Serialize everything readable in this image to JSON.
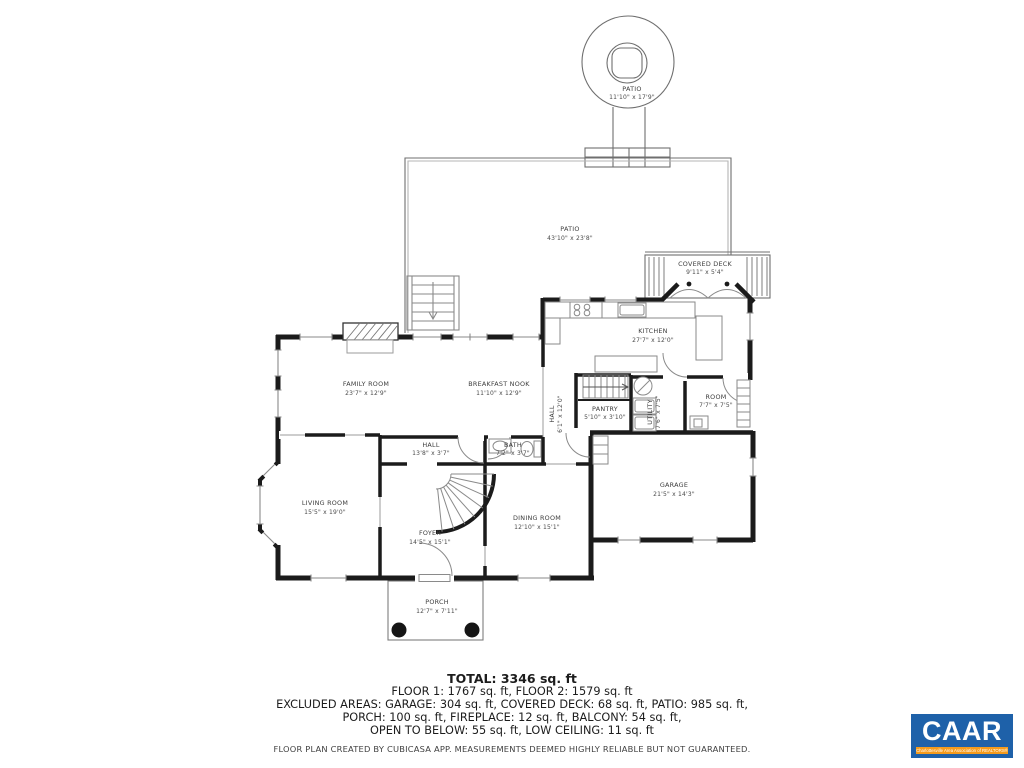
{
  "plan": {
    "rooms": [
      {
        "name": "PATIO",
        "dims": "11'10\" x 17'9\""
      },
      {
        "name": "PATIO",
        "dims": "43'10\" x 23'8\""
      },
      {
        "name": "COVERED DECK",
        "dims": "9'11\" x 5'4\""
      },
      {
        "name": "KITCHEN",
        "dims": "27'7\" x 12'0\""
      },
      {
        "name": "FAMILY ROOM",
        "dims": "23'7\" x 12'9\""
      },
      {
        "name": "BREAKFAST NOOK",
        "dims": "11'10\" x 12'9\""
      },
      {
        "name": "HALL",
        "dims": "6'1\" x 12'0\""
      },
      {
        "name": "PANTRY",
        "dims": "5'10\" x 3'10\""
      },
      {
        "name": "UTILITY",
        "dims": "7'6\" x 7'5\""
      },
      {
        "name": "ROOM",
        "dims": "7'7\" x 7'5\""
      },
      {
        "name": "HALL",
        "dims": "13'8\" x 3'7\""
      },
      {
        "name": "BATH",
        "dims": "7'2\" x 3'7\""
      },
      {
        "name": "LIVING ROOM",
        "dims": "15'5\" x 19'0\""
      },
      {
        "name": "FOYER",
        "dims": "14'5\" x 15'1\""
      },
      {
        "name": "DINING ROOM",
        "dims": "12'10\" x 15'1\""
      },
      {
        "name": "GARAGE",
        "dims": "21'5\" x 14'3\""
      },
      {
        "name": "PORCH",
        "dims": "12'7\" x 7'11\""
      }
    ]
  },
  "footer": {
    "total": "TOTAL: 3346 sq. ft",
    "floors": "FLOOR 1: 1767 sq. ft, FLOOR 2: 1579 sq. ft",
    "excluded1": "EXCLUDED AREAS: GARAGE: 304 sq. ft, COVERED DECK: 68 sq. ft, PATIO: 985 sq. ft,",
    "excluded2": "PORCH: 100 sq. ft, FIREPLACE: 12 sq. ft, BALCONY: 54 sq. ft,",
    "excluded3": "OPEN TO BELOW: 55 sq. ft, LOW CEILING: 11 sq. ft",
    "disclaimer": "FLOOR PLAN CREATED BY CUBICASA APP. MEASUREMENTS DEEMED HIGHLY RELIABLE BUT NOT GUARANTEED."
  },
  "logo": {
    "name": "CAAR",
    "tagline": "Charlottesville Area Association of REALTORS®",
    "blue": "#1e61a9",
    "orange": "#f49b1d"
  }
}
